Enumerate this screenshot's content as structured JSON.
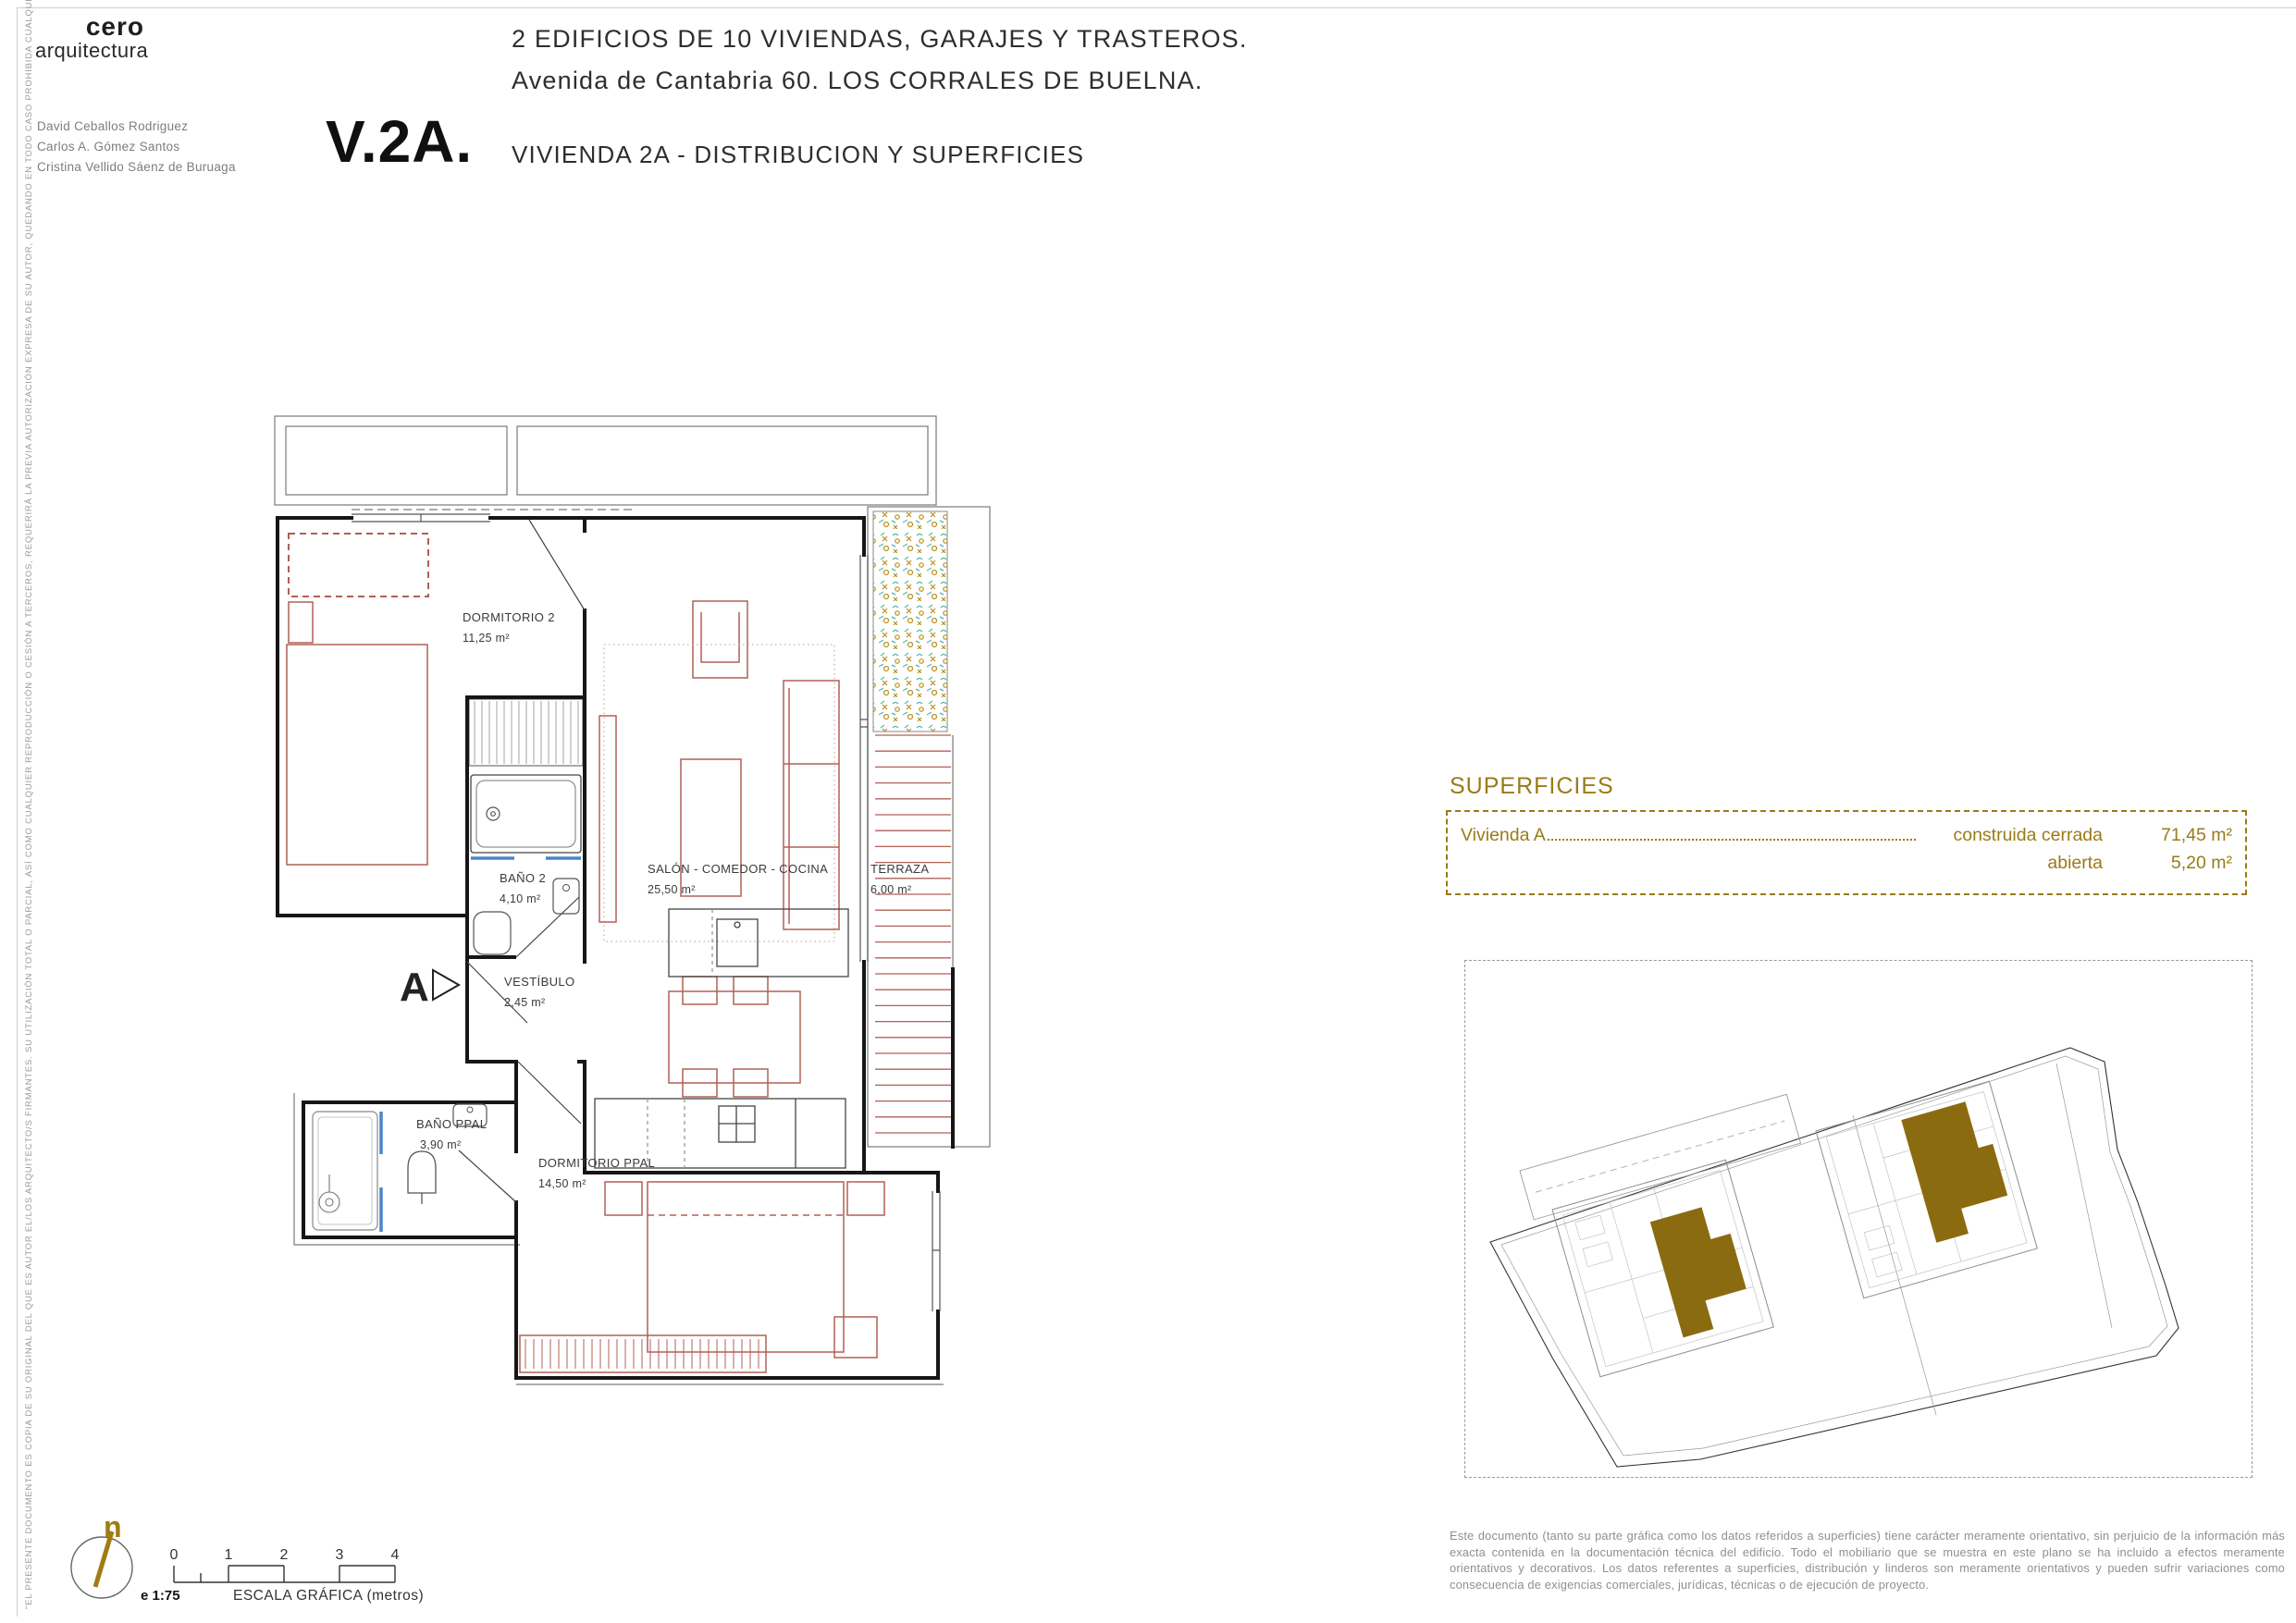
{
  "header": {
    "logo_line1": "cero",
    "logo_line2": "arquitectura",
    "architects": [
      "David Ceballos Rodriguez",
      "Carlos A. Gómez Santos",
      "Cristina Vellido Sáenz de Buruaga"
    ],
    "sheet_code": "V.2A.",
    "project_line1": "2 EDIFICIOS DE 10 VIVIENDAS, GARAJES Y TRASTEROS.",
    "project_line2": "Avenida de Cantabria 60. LOS CORRALES DE BUELNA.",
    "sheet_title": "VIVIENDA 2A -  DISTRIBUCION Y SUPERFICIES"
  },
  "plan": {
    "rooms": [
      {
        "name": "DORMITORIO 2",
        "area": "11,25 m²"
      },
      {
        "name": "BAÑO 2",
        "area": "4,10 m²"
      },
      {
        "name": "SALÓN - COMEDOR - COCINA",
        "area": "25,50 m²"
      },
      {
        "name": "TERRAZA",
        "area": "6,00 m²"
      },
      {
        "name": "VESTÍBULO",
        "area": "2,45 m²"
      },
      {
        "name": "BAÑO PPAL",
        "area": "3,90 m²"
      },
      {
        "name": "DORMITORIO PPAL",
        "area": "14,50 m²"
      }
    ],
    "section_marker": "A"
  },
  "superficies": {
    "title": "SUPERFICIES",
    "rows": [
      {
        "label": "Vivienda  A",
        "concept": "construida cerrada",
        "value": "71,45 m²"
      },
      {
        "label": "",
        "concept": "abierta",
        "value": "5,20 m²"
      }
    ]
  },
  "scale_bar": {
    "scale": "e 1:75",
    "label": "ESCALA GRÁFICA (metros)",
    "ticks": [
      "0",
      "1",
      "2",
      "3",
      "4"
    ],
    "north_letter": "n"
  },
  "legal": {
    "vertical_note": "\"EL PRESENTE DOCUMENTO ES COPIA DE SU ORIGINAL DEL QUE ES AUTOR EL/LOS ARQUITECTO/S FIRMANTES. SU UTILIZACIÓN TOTAL O PARCIAL, ASÍ COMO CUALQUIER REPRODUCCIÓN O CESIÓN A TERCEROS, REQUERIRÁ LA PREVIA AUTORIZACIÓN EXPRESA DE SU AUTOR, QUEDANDO EN TODO CASO PROHIBIDA CUALQUIER MODIFICACIÓN UNILATERAL DEL MISMO.\"",
    "disclaimer": "Este documento (tanto su parte gráfica como los datos referidos a superficies) tiene carácter meramente orientativo, sin perjuicio de la información más exacta contenida en la documentación técnica del edificio. Todo el mobiliario que se muestra en este plano se ha incluido a efectos meramente orientativos y decorativos. Los datos referentes a superficies, distribución y linderos son meramente orientativos y pueden sufrir variaciones como consecuencia de exigencias comerciales, jurídicas, técnicas o de ejecución de proyecto."
  },
  "colors": {
    "accent_gold": "#9a7b17",
    "site_highlight_gold": "#8b6b10",
    "furniture_red": "#b06055",
    "wall_black": "#161616",
    "accent_blue": "#4a86c8",
    "plant_teal": "#2fa79b"
  }
}
